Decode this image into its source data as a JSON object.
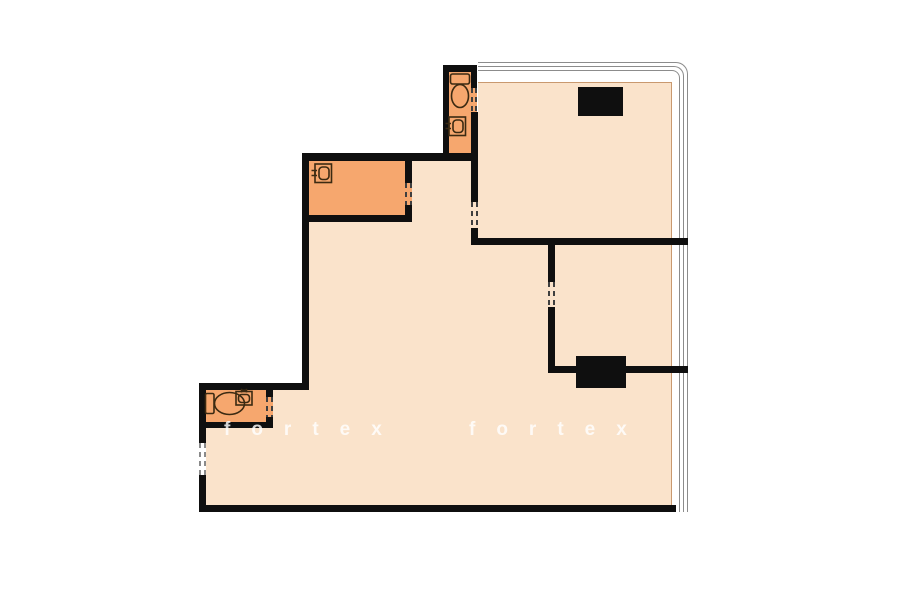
{
  "canvas": {
    "width": 900,
    "height": 604,
    "background": "#ffffff"
  },
  "colors": {
    "wall": "#0f0f0f",
    "room_light": "#fae3cb",
    "room_dark": "#f6a76e",
    "edge_line": "#c9996f",
    "window_line": "#8c8c8c",
    "fixture_outline": "#3b2a12",
    "opening_dash_dark": "#3f3f3f",
    "opening_dash_light": "#8a8a8a",
    "watermark": "rgba(255,255,255,0.82)"
  },
  "regions": [
    {
      "name": "main-living-area",
      "x": 309,
      "y": 161,
      "w": 363,
      "h": 344,
      "fill": "room_light",
      "border_right": true
    },
    {
      "name": "top-right-room",
      "x": 478,
      "y": 82,
      "w": 194,
      "h": 156,
      "fill": "room_light",
      "border_top": true,
      "border_right": true
    },
    {
      "name": "entry-area",
      "x": 206,
      "y": 390,
      "w": 103,
      "h": 115,
      "fill": "room_light"
    },
    {
      "name": "kitchen-room",
      "x": 309,
      "y": 161,
      "w": 96,
      "h": 54,
      "fill": "room_dark"
    },
    {
      "name": "bathroom-top",
      "x": 449,
      "y": 71,
      "w": 22,
      "h": 82,
      "fill": "room_dark"
    },
    {
      "name": "bathroom-bottom",
      "x": 206,
      "y": 390,
      "w": 60,
      "h": 32,
      "fill": "room_dark"
    }
  ],
  "window_lines": [
    {
      "x": 478,
      "y": 62,
      "w": 210,
      "h": 450,
      "r": 12
    },
    {
      "x": 478,
      "y": 66,
      "w": 206,
      "h": 446,
      "r": 10
    },
    {
      "x": 478,
      "y": 70,
      "w": 202,
      "h": 442,
      "r": 8
    }
  ],
  "walls": [
    {
      "x": 302,
      "y": 153,
      "w": 176,
      "h": 8
    },
    {
      "x": 443,
      "y": 65,
      "w": 6,
      "h": 96
    },
    {
      "x": 443,
      "y": 65,
      "w": 34,
      "h": 7
    },
    {
      "x": 471,
      "y": 65,
      "w": 6,
      "h": 23
    },
    {
      "x": 471,
      "y": 112,
      "w": 7,
      "h": 90
    },
    {
      "x": 471,
      "y": 228,
      "w": 7,
      "h": 16
    },
    {
      "x": 471,
      "y": 238,
      "w": 217,
      "h": 7
    },
    {
      "x": 548,
      "y": 245,
      "w": 7,
      "h": 37
    },
    {
      "x": 548,
      "y": 307,
      "w": 7,
      "h": 65
    },
    {
      "x": 548,
      "y": 366,
      "w": 140,
      "h": 7
    },
    {
      "x": 302,
      "y": 153,
      "w": 7,
      "h": 237
    },
    {
      "x": 405,
      "y": 161,
      "w": 7,
      "h": 22
    },
    {
      "x": 405,
      "y": 205,
      "w": 7,
      "h": 17
    },
    {
      "x": 302,
      "y": 215,
      "w": 110,
      "h": 7
    },
    {
      "x": 199,
      "y": 383,
      "w": 110,
      "h": 7
    },
    {
      "x": 199,
      "y": 390,
      "w": 7,
      "h": 53
    },
    {
      "x": 199,
      "y": 475,
      "w": 7,
      "h": 37
    },
    {
      "x": 199,
      "y": 505,
      "w": 477,
      "h": 7
    },
    {
      "x": 266,
      "y": 390,
      "w": 7,
      "h": 7
    },
    {
      "x": 266,
      "y": 417,
      "w": 7,
      "h": 11
    },
    {
      "x": 199,
      "y": 422,
      "w": 74,
      "h": 6
    }
  ],
  "shafts": [
    {
      "name": "shaft-top",
      "x": 578,
      "y": 87,
      "w": 45,
      "h": 29
    },
    {
      "name": "shaft-bottom",
      "x": 576,
      "y": 356,
      "w": 50,
      "h": 32
    }
  ],
  "openings": [
    {
      "name": "door-opening-bathroom-top",
      "x": 471,
      "y": 88,
      "w": 6,
      "h": 24,
      "bg": "room_dark",
      "dash": "dark"
    },
    {
      "name": "door-opening-kitchen",
      "x": 405,
      "y": 183,
      "w": 7,
      "h": 22,
      "bg": "room_dark",
      "dash": "dark"
    },
    {
      "name": "door-opening-hall",
      "x": 471,
      "y": 202,
      "w": 7,
      "h": 26,
      "bg": "room_light",
      "dash": "dark"
    },
    {
      "name": "door-opening-bedroom",
      "x": 548,
      "y": 282,
      "w": 7,
      "h": 25,
      "bg": "room_light",
      "dash": "dark"
    },
    {
      "name": "door-opening-bathroom-bottom",
      "x": 266,
      "y": 397,
      "w": 7,
      "h": 20,
      "bg": "room_dark",
      "dash": "dark"
    },
    {
      "name": "entrance-opening",
      "x": 199,
      "y": 443,
      "w": 7,
      "h": 32,
      "bg": "#ffffff",
      "dash": "light"
    }
  ],
  "fixtures": [
    {
      "name": "toilet-icon",
      "type": "toilet-v",
      "x": 449,
      "y": 72,
      "w": 22,
      "h": 38
    },
    {
      "name": "sink-icon",
      "type": "sink-left",
      "x": 445,
      "y": 116,
      "w": 22,
      "h": 21
    },
    {
      "name": "sink-icon",
      "type": "sink-left",
      "x": 311,
      "y": 163,
      "w": 22,
      "h": 21
    },
    {
      "name": "toilet-icon",
      "type": "toilet-h",
      "x": 204,
      "y": 391,
      "w": 44,
      "h": 26
    },
    {
      "name": "sink-icon",
      "type": "sink-top",
      "x": 235,
      "y": 388,
      "w": 18,
      "h": 18
    }
  ],
  "watermark": {
    "words": [
      {
        "text": "fortex",
        "x": 224,
        "y": 419
      },
      {
        "text": "fortex",
        "x": 469,
        "y": 419
      }
    ],
    "font_size": 19,
    "letter_spacing": 21
  }
}
